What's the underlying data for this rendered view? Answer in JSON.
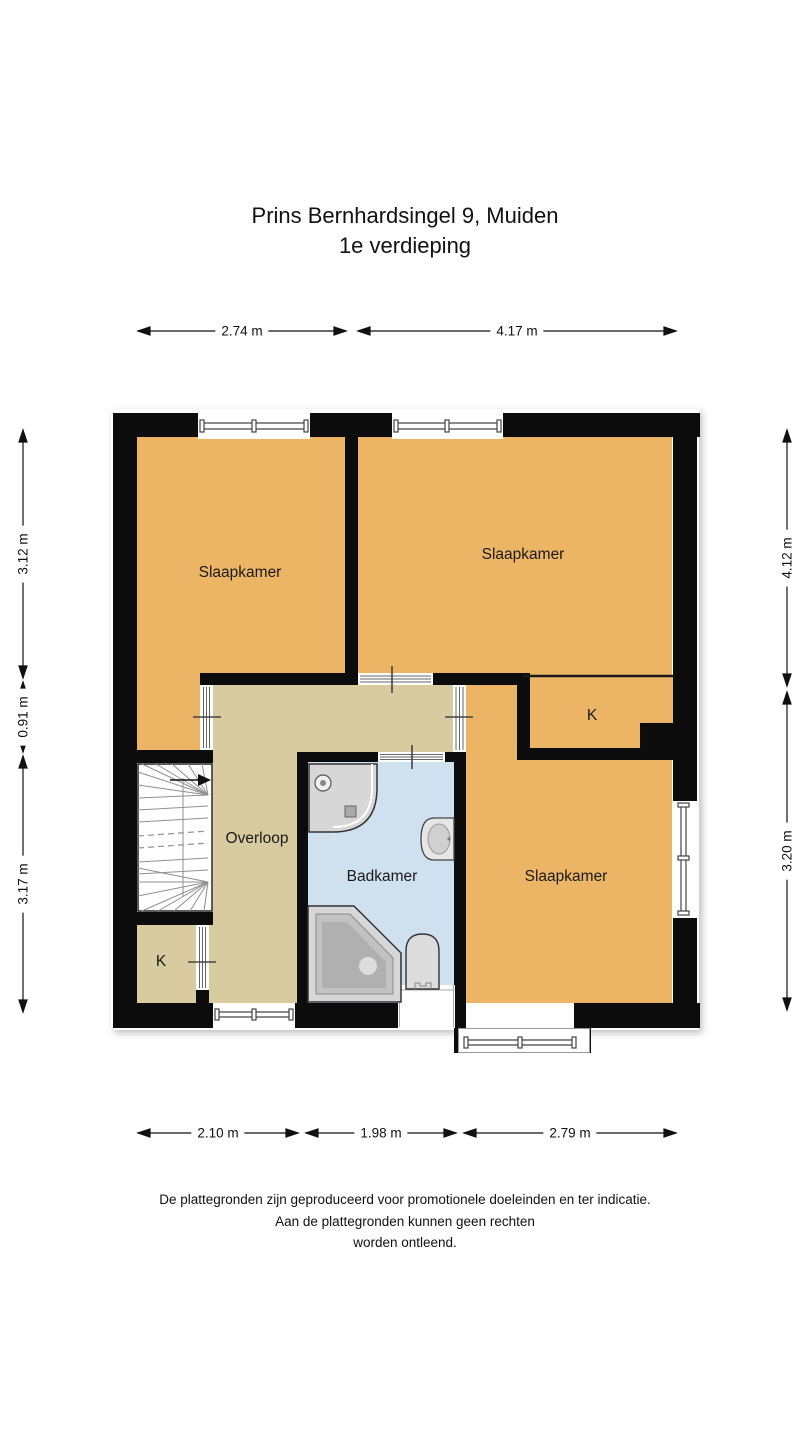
{
  "title": {
    "line1": "Prins Bernhardsingel 9, Muiden",
    "line2": "1e verdieping"
  },
  "rooms": {
    "bedroom_top_left": "Slaapkamer",
    "bedroom_top_right": "Slaapkamer",
    "bedroom_bottom_right": "Slaapkamer",
    "landing": "Overloop",
    "bathroom": "Badkamer",
    "closet_bottom_left": "K",
    "closet_top_right": "K"
  },
  "dimensions": {
    "top": [
      "2.74 m",
      "4.17 m"
    ],
    "bottom": [
      "2.10 m",
      "1.98 m",
      "2.79 m"
    ],
    "left": [
      "3.12 m",
      "0.91 m",
      "3.17 m"
    ],
    "right": [
      "4.12 m",
      "3.20 m"
    ]
  },
  "footer": {
    "line1": "De plattegronden zijn geproduceerd voor promotionele doeleinden en ter indicatie.",
    "line2": "Aan de plattegronden kunnen geen rechten",
    "line3": "worden ontleend."
  },
  "colors": {
    "room_orange": "#ecb566",
    "hall_tan": "#d8cba0",
    "bath_blue": "#cfe0ee",
    "wall_black": "#0c0c0c",
    "background": "#ffffff"
  }
}
